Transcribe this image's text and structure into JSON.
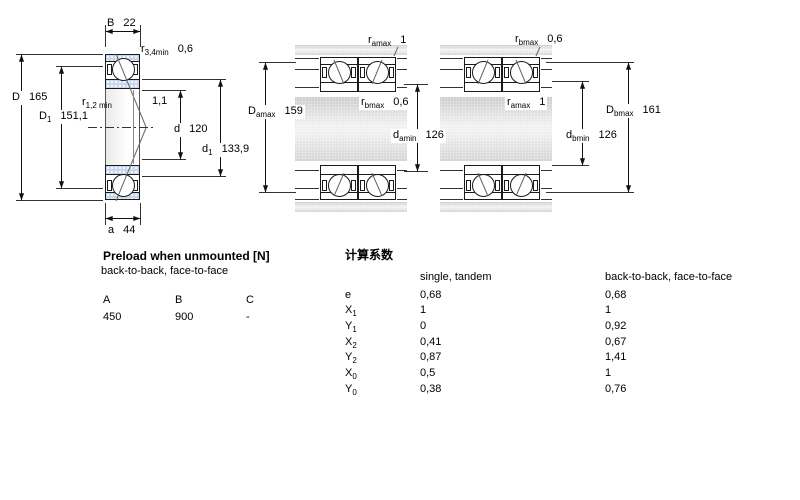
{
  "drawings": {
    "single": {
      "dims": {
        "B": {
          "base": "B",
          "sub": "",
          "value": "22"
        },
        "r34": {
          "base": "r",
          "sub": "3,4min",
          "value": "0,6"
        },
        "D": {
          "base": "D",
          "sub": "",
          "value": "165"
        },
        "D1": {
          "base": "D",
          "sub": "1",
          "value": "151,1"
        },
        "r12": {
          "base": "r",
          "sub": "1,2 min",
          "value": "1,1"
        },
        "d": {
          "base": "d",
          "sub": "",
          "value": "120"
        },
        "d1": {
          "base": "d",
          "sub": "1",
          "value": "133,9"
        },
        "a": {
          "base": "a",
          "sub": "",
          "value": "44"
        }
      }
    },
    "back_to_back": {
      "dims": {
        "ra": {
          "base": "r",
          "sub": "amax",
          "value": "1"
        },
        "Da": {
          "base": "D",
          "sub": "amax",
          "value": "159"
        },
        "rb": {
          "base": "r",
          "sub": "bmax",
          "value": "0,6"
        },
        "da": {
          "base": "d",
          "sub": "amin",
          "value": "126"
        }
      }
    },
    "face_to_face": {
      "dims": {
        "rb": {
          "base": "r",
          "sub": "bmax",
          "value": "0,6"
        },
        "ra": {
          "base": "r",
          "sub": "amax",
          "value": "1"
        },
        "Db": {
          "base": "D",
          "sub": "bmax",
          "value": "161"
        },
        "db": {
          "base": "d",
          "sub": "bmin",
          "value": "126"
        }
      }
    }
  },
  "preload_table": {
    "title": "Preload when unmounted [N]",
    "subtitle": "back-to-back, face-to-face",
    "headers": [
      "A",
      "B",
      "C"
    ],
    "values": [
      "450",
      "900",
      "-"
    ]
  },
  "factors_table": {
    "title": "计算系数",
    "col1_header": "single, tandem",
    "col2_header": "back-to-back, face-to-face",
    "rows": [
      {
        "base": "e",
        "sub": "",
        "v1": "0,68",
        "v2": "0,68"
      },
      {
        "base": "X",
        "sub": "1",
        "v1": "1",
        "v2": "1"
      },
      {
        "base": "Y",
        "sub": "1",
        "v1": "0",
        "v2": "0,92"
      },
      {
        "base": "X",
        "sub": "2",
        "v1": "0,41",
        "v2": "0,67"
      },
      {
        "base": "Y",
        "sub": "2",
        "v1": "0,87",
        "v2": "1,41"
      },
      {
        "base": "X",
        "sub": "0",
        "v1": "0,5",
        "v2": "1"
      },
      {
        "base": "Y",
        "sub": "0",
        "v1": "0,38",
        "v2": "0,76"
      }
    ]
  },
  "colors": {
    "ring_blue": "#c9d7ee",
    "steel_gray": "#d4d4d4"
  }
}
